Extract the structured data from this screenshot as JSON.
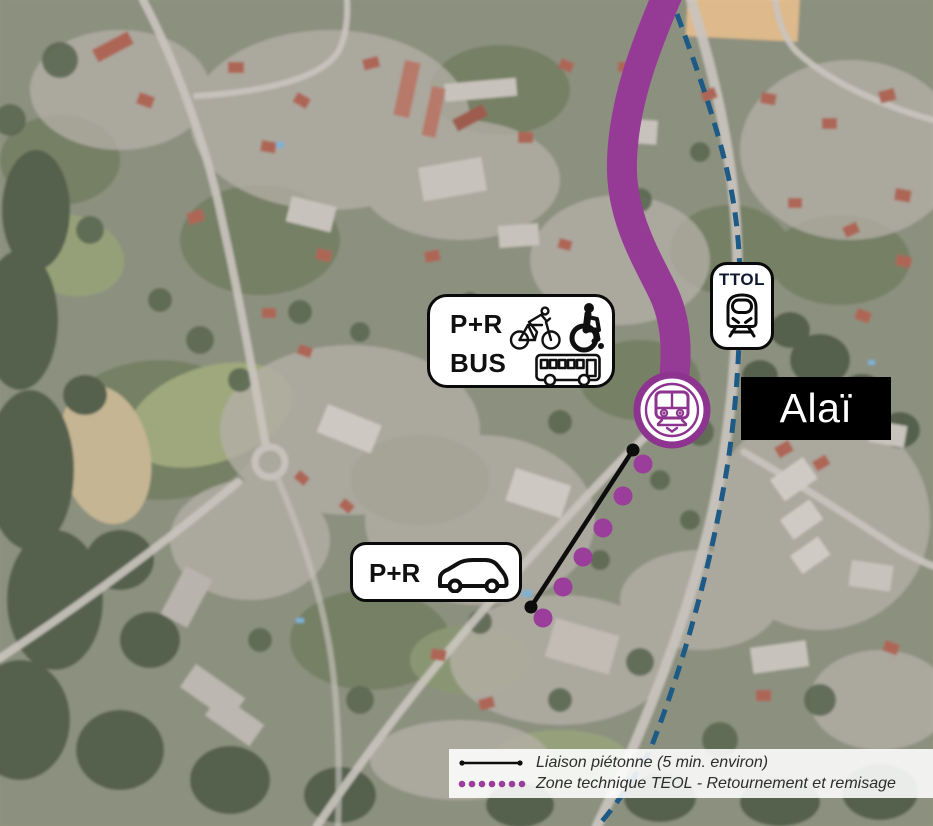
{
  "station_label": "Alaï",
  "ttol_badge": {
    "label": "TTOL"
  },
  "pr_bus_badge": {
    "line1": "P+R",
    "line2": "BUS"
  },
  "pr_car_badge": {
    "label": "P+R"
  },
  "legend": {
    "items": [
      {
        "symbol": "black-line-with-dots",
        "label": "Liaison piétonne (5 min. environ)"
      },
      {
        "symbol": "purple-dots",
        "label": "Zone technique TEOL - Retournement et remisage"
      }
    ]
  },
  "colors": {
    "teol_line": "#963b95",
    "station_ring": "#8d3390",
    "technical_zone_dots": "#9b3d9b",
    "ttol_dashed_line": "#1e5a86",
    "pedestrian_line": "#0d0d0d",
    "label_bg": "#000000",
    "label_text": "#ffffff"
  }
}
